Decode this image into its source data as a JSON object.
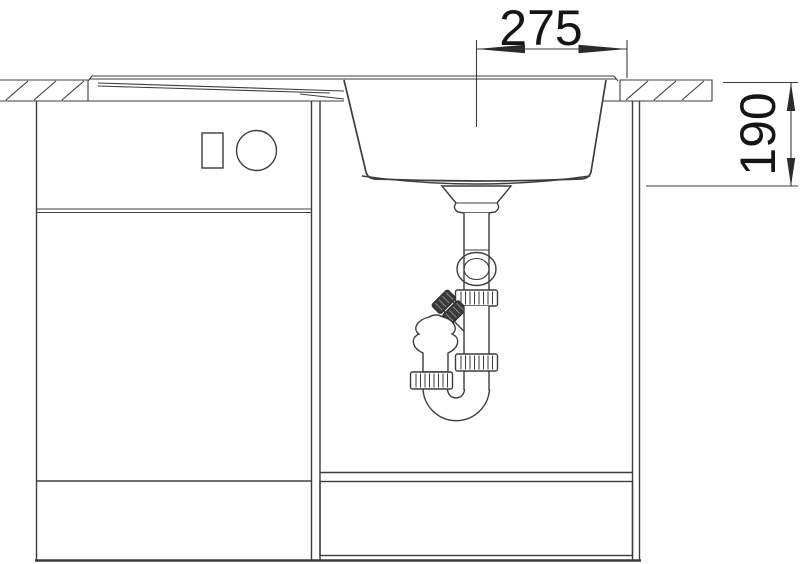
{
  "drawing": {
    "dimensions": {
      "width": {
        "label": "275"
      },
      "depth": {
        "label": "190"
      }
    }
  },
  "colors": {
    "line": "#3d3d3d",
    "text": "#151515",
    "background": "#ffffff",
    "knurl_dark": "#3a3a3a"
  }
}
